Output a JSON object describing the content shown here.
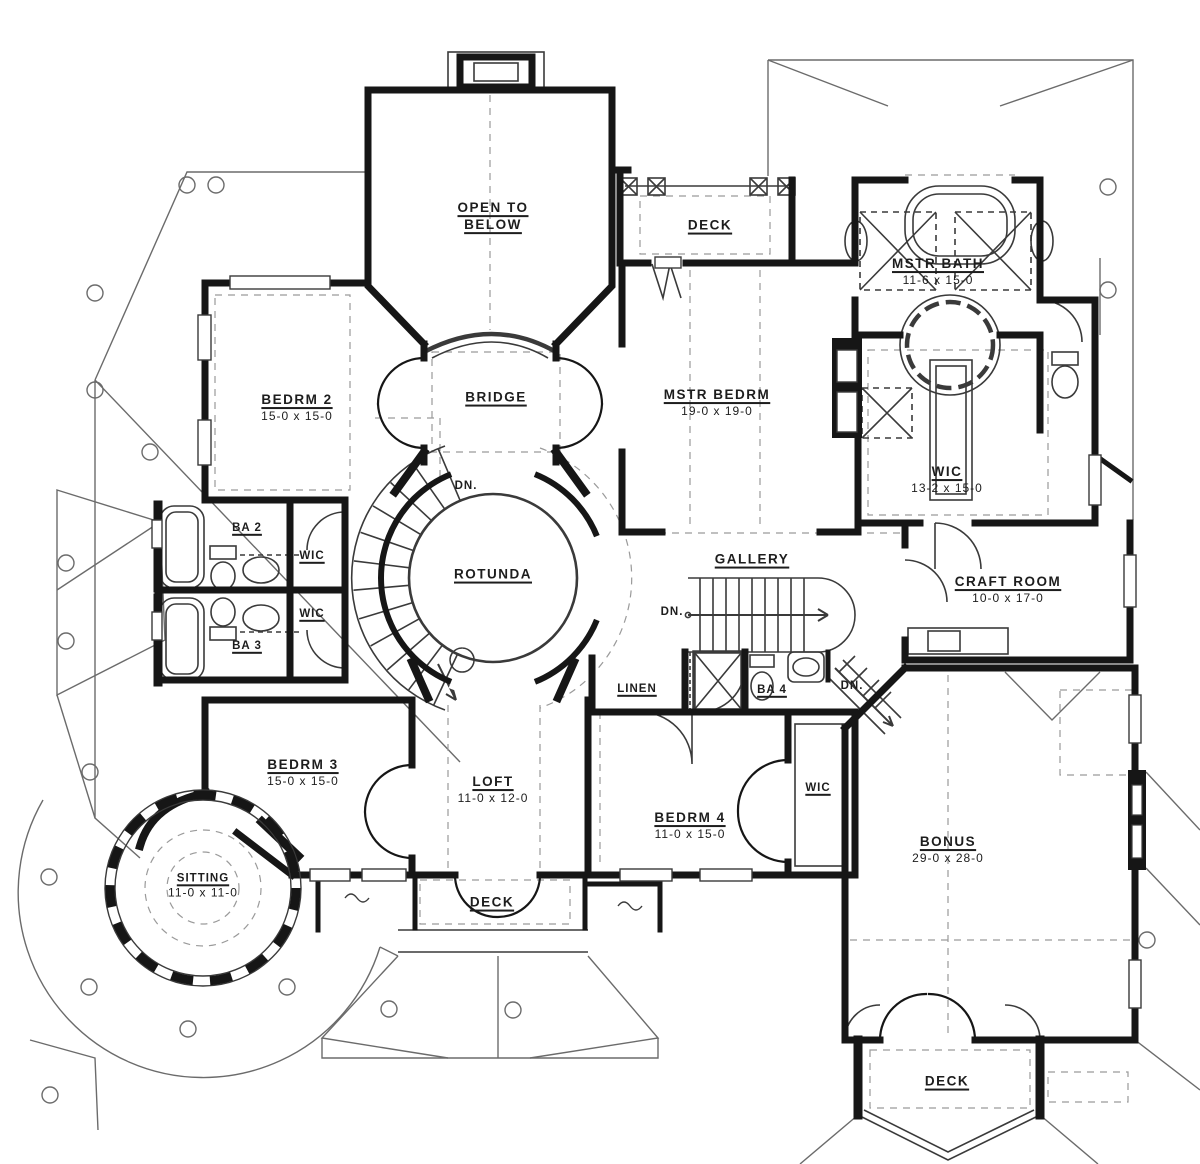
{
  "palette": {
    "ink": "#161616",
    "fixture": "#3a3a3a",
    "roof": "#6b6b6b",
    "dash": "#9a9a9a",
    "bg": "#ffffff"
  },
  "rooms": [
    {
      "id": "open-to-below",
      "name": "OPEN TO BELOW",
      "dims": ""
    },
    {
      "id": "deck-top",
      "name": "DECK",
      "dims": ""
    },
    {
      "id": "mstr-bath",
      "name": "MSTR BATH",
      "dims": "11-6 x 15-0"
    },
    {
      "id": "bedrm-2",
      "name": "BEDRM 2",
      "dims": "15-0 x 15-0"
    },
    {
      "id": "bridge",
      "name": "BRIDGE",
      "dims": ""
    },
    {
      "id": "mstr-bedrm",
      "name": "MSTR BEDRM",
      "dims": "19-0 x 19-0"
    },
    {
      "id": "wic-mstr",
      "name": "WIC",
      "dims": "13-2 x 15-0"
    },
    {
      "id": "ba-2",
      "name": "BA 2",
      "dims": ""
    },
    {
      "id": "wic-ba2",
      "name": "WIC",
      "dims": ""
    },
    {
      "id": "ba-3",
      "name": "BA 3",
      "dims": ""
    },
    {
      "id": "wic-ba3",
      "name": "WIC",
      "dims": ""
    },
    {
      "id": "rotunda",
      "name": "ROTUNDA",
      "dims": ""
    },
    {
      "id": "gallery",
      "name": "GALLERY",
      "dims": ""
    },
    {
      "id": "craft-room",
      "name": "CRAFT ROOM",
      "dims": "10-0 x 17-0"
    },
    {
      "id": "linen",
      "name": "LINEN",
      "dims": ""
    },
    {
      "id": "ba-4",
      "name": "BA 4",
      "dims": ""
    },
    {
      "id": "bedrm-3",
      "name": "BEDRM 3",
      "dims": "15-0 x 15-0"
    },
    {
      "id": "loft",
      "name": "LOFT",
      "dims": "11-0 x 12-0"
    },
    {
      "id": "bedrm-4",
      "name": "BEDRM 4",
      "dims": "11-0 x 15-0"
    },
    {
      "id": "wic-bedrm4",
      "name": "WIC",
      "dims": ""
    },
    {
      "id": "bonus",
      "name": "BONUS",
      "dims": "29-0 x 28-0"
    },
    {
      "id": "sitting",
      "name": "SITTING",
      "dims": "11-0 x 11-0"
    },
    {
      "id": "deck-bottom",
      "name": "DECK",
      "dims": ""
    },
    {
      "id": "deck-bottom-right",
      "name": "DECK",
      "dims": ""
    }
  ],
  "annotations": [
    {
      "id": "dn-rotunda",
      "label": "DN."
    },
    {
      "id": "dn-gallery",
      "label": "DN."
    },
    {
      "id": "dn-bonus",
      "label": "DN."
    }
  ]
}
